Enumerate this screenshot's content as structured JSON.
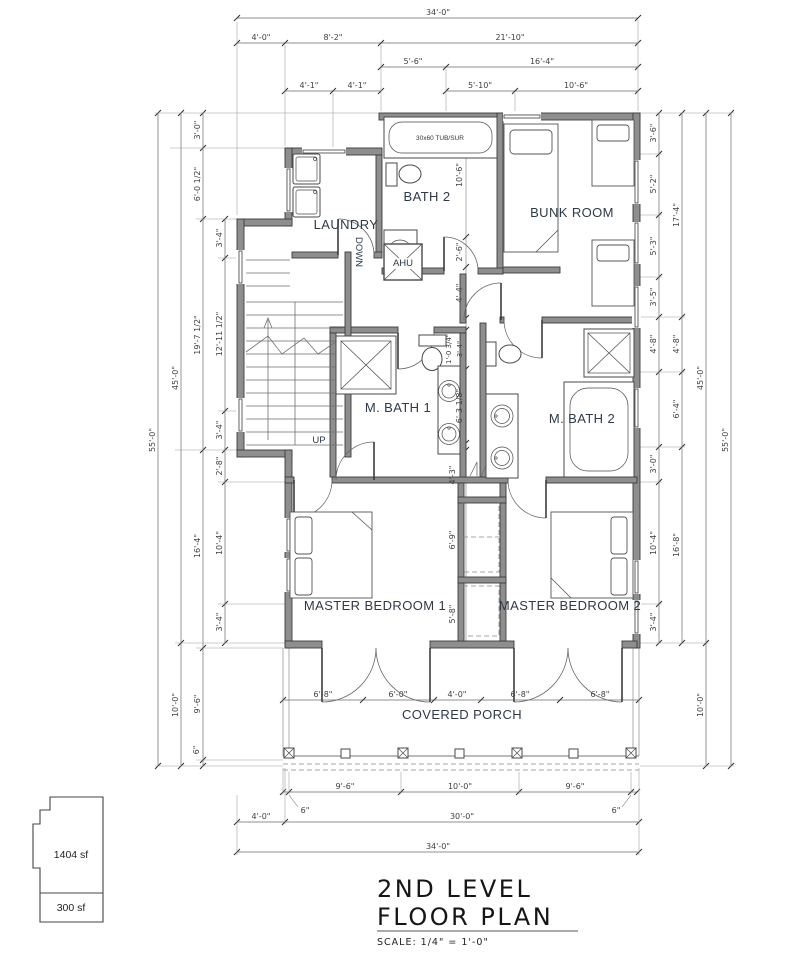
{
  "drawing": {
    "title_line1": "2ND LEVEL",
    "title_line2": "FLOOR PLAN",
    "scale_note": "SCALE: 1/4\" = 1'-0\""
  },
  "key_plan": {
    "main_area": "1404 sf",
    "porch_area": "300 sf"
  },
  "rooms": {
    "laundry": "LAUNDRY",
    "bath2": "BATH 2",
    "bunk_room": "BUNK ROOM",
    "m_bath1": "M. BATH 1",
    "m_bath2": "M. BATH 2",
    "master1": "MASTER BEDROOM 1",
    "master2": "MASTER BEDROOM 2",
    "porch": "COVERED PORCH",
    "down": "DOWN",
    "up": "UP",
    "ahu": "AHU",
    "tub_label": "30x60 TUB/SUR"
  },
  "dims": {
    "top": {
      "overall": "34'-0\"",
      "a": "4'-0\"",
      "b": "8'-2\"",
      "c": "21'-10\"",
      "d": "5'-6\"",
      "e": "16'-4\"",
      "f": "4'-1\"",
      "g": "4'-1\"",
      "h": "5'-10\"",
      "i": "10'-6\""
    },
    "left": {
      "overall": "55'-0\"",
      "main": "45'-0\"",
      "porch": "10'-0\"",
      "c1": "3'-0\"",
      "c2": "6'-0 1/2\"",
      "c3": "19'-7 1/2\"",
      "c4": "16'-4\"",
      "c5": "9'-6\"",
      "c6": "6\"",
      "d1": "3'-4\"",
      "d2": "12'-11 1/2\"",
      "d3": "3'-4\"",
      "d4": "2'-8\"",
      "d5": "10'-4\"",
      "d6": "3'-4\""
    },
    "right": {
      "overall": "55'-0\"",
      "main": "45'-0\"",
      "porch": "10'-0\"",
      "a1": "3'-6\"",
      "a2": "5'-2\"",
      "a3": "5'-3\"",
      "a4": "3'-5\"",
      "a5": "4'-8\"",
      "a6": "3'-0\"",
      "a7": "10'-4\"",
      "a8": "3'-4\"",
      "b1": "17'-4\"",
      "b2": "4'-8\"",
      "b3": "6'-4\"",
      "b4": "16'-8\""
    },
    "bottom": {
      "overall": "34'-0\"",
      "a": "4'-0\"",
      "b": "30'-0\"",
      "c": "9'-6\"",
      "d": "10'-0\"",
      "e": "9'-6\"",
      "f": "6\"",
      "g": "6\""
    },
    "porch": {
      "p1": "6'-8\"",
      "p2": "6'-0\"",
      "p3": "4'-0\"",
      "p4": "6'-8\"",
      "p5": "6'-8\""
    },
    "interior": {
      "i1": "10'-6\"",
      "i2": "2'-6\"",
      "i3": "4'-4\"",
      "i4": "1'-0 3/4\"",
      "i5": "3'-4\"",
      "i6": "6'-3 1/8\"",
      "i7": "4'-3\"",
      "i8": "6'-9\"",
      "i9": "5'-8\""
    }
  }
}
